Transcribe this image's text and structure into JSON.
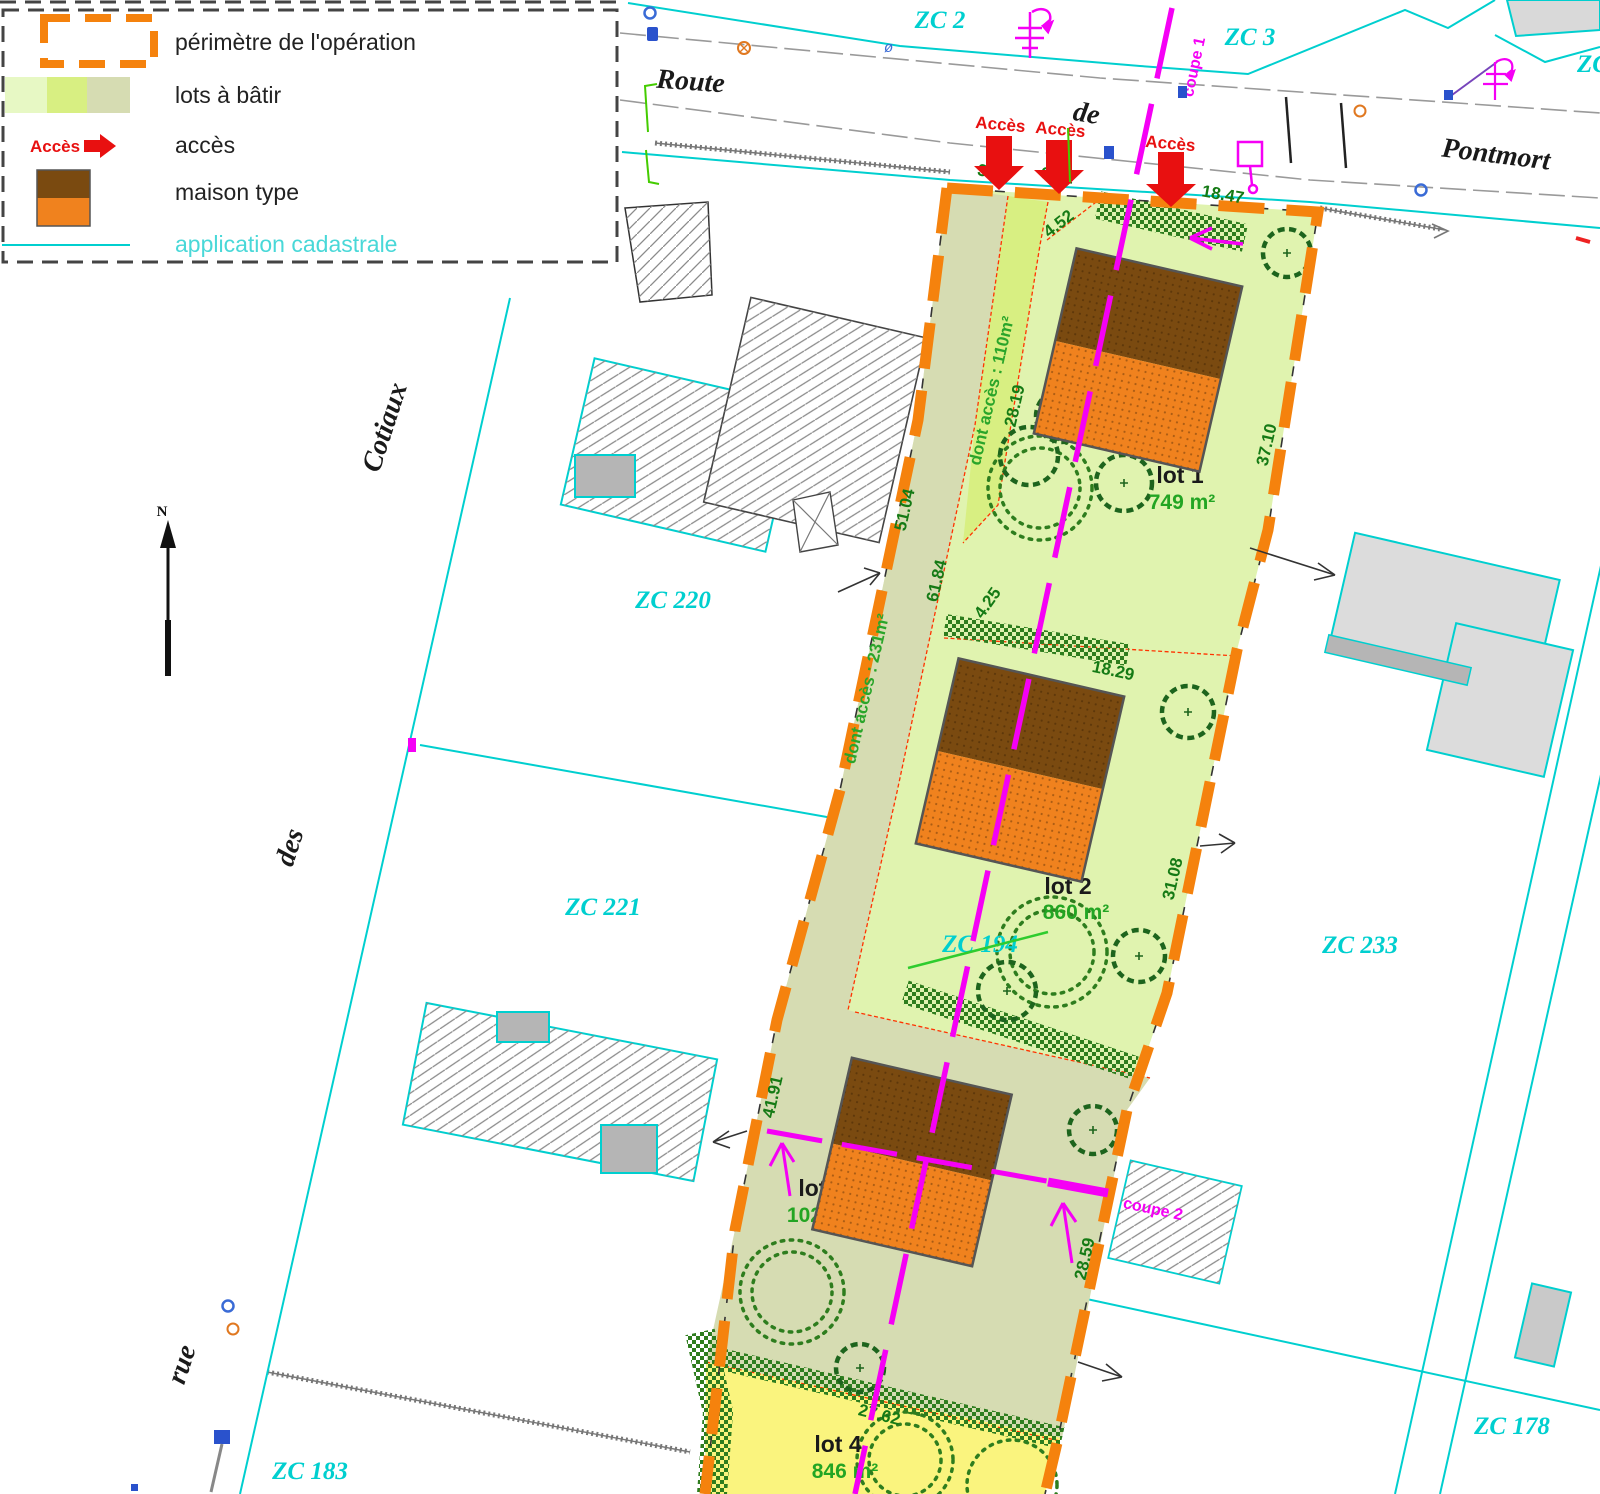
{
  "legend": {
    "perimeter_label": "périmètre de l'opération",
    "lots_label": "lots à bâtir",
    "access_key_label": "Accès",
    "access_label": "accès",
    "house_label": "maison type",
    "cadastral_label": "application cadastrale"
  },
  "map": {
    "north_label": "N",
    "streets": {
      "route": "Route",
      "de": "de",
      "pontmort": "Pontmort",
      "rue": "rue",
      "des": "des",
      "cotiaux": "Cotiaux"
    },
    "parcels": {
      "zc2": "ZC 2",
      "zc3": "ZC 3",
      "zc_edge": "ZC",
      "zc220": "ZC 220",
      "zc221": "ZC 221",
      "zc233": "ZC 233",
      "zc194": "ZC 194",
      "zc183": "ZC 183",
      "zc178": "ZC 178"
    },
    "lots": [
      {
        "name": "lot 1",
        "area": "749 m²"
      },
      {
        "name": "lot 2",
        "area": "860 m²"
      },
      {
        "name": "lot 3",
        "area": "1026 m²"
      },
      {
        "name": "lot 4",
        "area": "846 m²"
      }
    ],
    "access_arrows": [
      "Accès",
      "Accès",
      "Accès"
    ],
    "access_areas": {
      "lot1": "dont accès : 110m²",
      "lot23": "dont accès : 231m²"
    },
    "sections": {
      "coupe1": "coupe 1",
      "coupe2": "coupe 2"
    },
    "dims": {
      "w355": "3.55",
      "w601": "6.01",
      "d1847": "18.47",
      "d452": "4.52",
      "d2819": "28.19",
      "d3710": "37.10",
      "d5104": "51.04",
      "d6184": "61.84",
      "d425": "4.25",
      "d1829": "18.29",
      "d3108": "31.08",
      "d4191": "41.91",
      "d2859": "28.59",
      "d2762": "27.62"
    },
    "colors": {
      "perimeter_orange": "#f5820d",
      "cadastral_cyan": "#00cfcf",
      "access_red": "#e81010",
      "section_magenta": "#f500f5",
      "house_brown": "#7a4a10",
      "house_orange": "#f0821e",
      "lot_pale": "#e0f3af",
      "lot_bright": "#d8ef82",
      "lot_olive": "#d6dcb2",
      "lot_yellow": "#faf47e",
      "hedge_green": "#2e7d1e"
    }
  }
}
